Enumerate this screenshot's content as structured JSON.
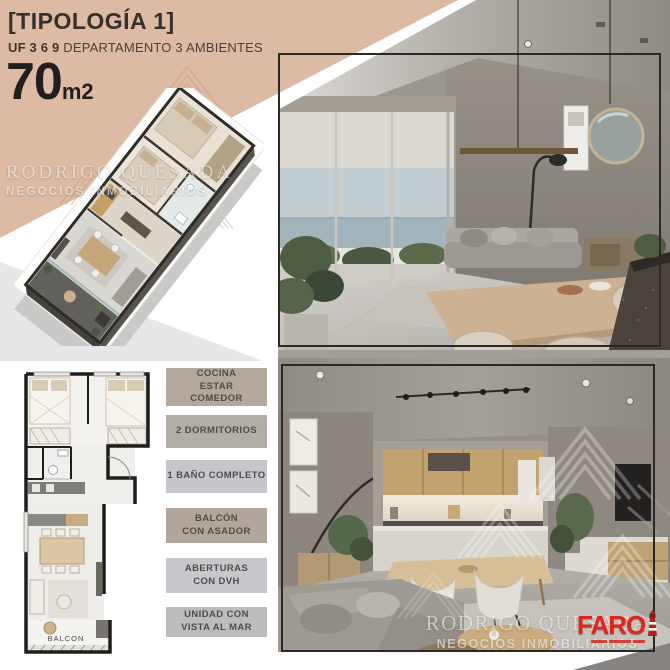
{
  "flyer": {
    "header": {
      "title": "[TIPOLOGÍA 1]",
      "unit_label": "UF 3 6 9",
      "unit_desc": " DEPARTAMENTO 3 AMBIENTES",
      "area": "70",
      "area_unit": "m2"
    },
    "features": [
      {
        "lines": [
          "COCINA",
          "ESTAR",
          "COMEDOR"
        ],
        "bg": "#b2a89b"
      },
      {
        "lines": [
          "2 DORMITORIOS"
        ],
        "bg": "#b1ada7"
      },
      {
        "lines": [
          "1 BAÑO COMPLETO"
        ],
        "bg": "#c6c7cc"
      },
      {
        "lines": [
          "BALCÓN",
          "CON ASADOR"
        ],
        "bg": "#b0a69b"
      },
      {
        "lines": [
          "ABERTURAS",
          "CON DVH"
        ],
        "bg": "#c7c8cb"
      },
      {
        "lines": [
          "UNIDAD CON",
          "VISTA AL MAR"
        ],
        "bg": "#bbbcbe"
      }
    ],
    "floorplan": {
      "balcony_label": "BALCON"
    },
    "watermark": {
      "name": "RODRIGO QUESADA",
      "tagline": "NEGOCIOS INMOBILIARIOS"
    },
    "brand_logo": {
      "wordmark": "FARO",
      "color": "#e0241f"
    },
    "colors": {
      "tan_bg": "#dcbaa3",
      "accent_red": "#e0241f",
      "photo_frame": "#2b2925",
      "box_text": "#504d49"
    }
  }
}
